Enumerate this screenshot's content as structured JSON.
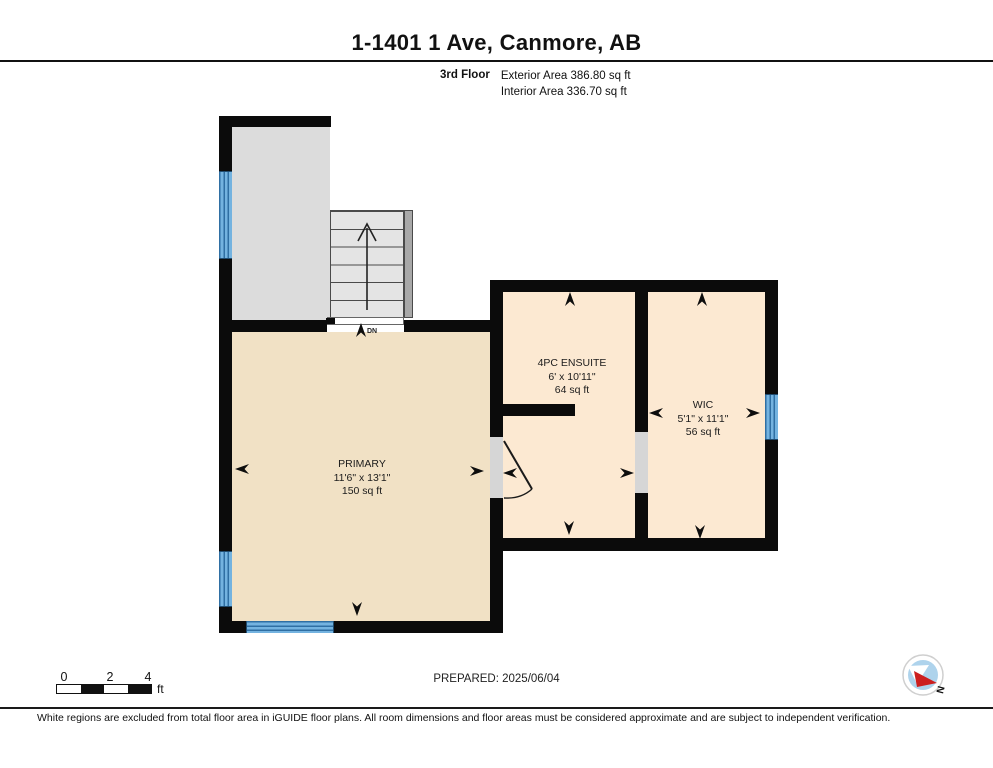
{
  "header": {
    "title": "1-1401 1 Ave, Canmore, AB",
    "floor_label": "3rd Floor",
    "exterior_area": "Exterior Area 386.80 sq ft",
    "interior_area": "Interior Area 336.70 sq ft"
  },
  "rooms": {
    "primary": {
      "name": "PRIMARY",
      "dimensions": "11'6\" x 13'1\"",
      "area": "150 sq ft"
    },
    "ensuite": {
      "name": "4PC ENSUITE",
      "dimensions": "6' x 10'11\"",
      "area": "64 sq ft"
    },
    "wic": {
      "name": "WIC",
      "dimensions": "5'1\" x 11'1\"",
      "area": "56 sq ft"
    }
  },
  "stairs": {
    "direction_label": "DN"
  },
  "scale_bar": {
    "labels": [
      "0",
      "2",
      "4"
    ],
    "unit": "ft"
  },
  "compass": {
    "north_label": "N"
  },
  "footer": {
    "prepared": "PREPARED: 2025/06/04",
    "disclaimer": "White regions are excluded from total floor area in iGUIDE floor plans. All room dimensions and floor areas must be considered approximate and are subject to independent verification."
  },
  "colors": {
    "wall": "#0b0b0b",
    "room_primary_fill": "#f1e1c5",
    "room_wet_fill": "#fce9d2",
    "excluded_region_fill": "#dcdcdc",
    "window_blue": "#74b3e0",
    "compass_needle_red": "#cc1f1f",
    "compass_inner_blue": "#aed3ec"
  }
}
